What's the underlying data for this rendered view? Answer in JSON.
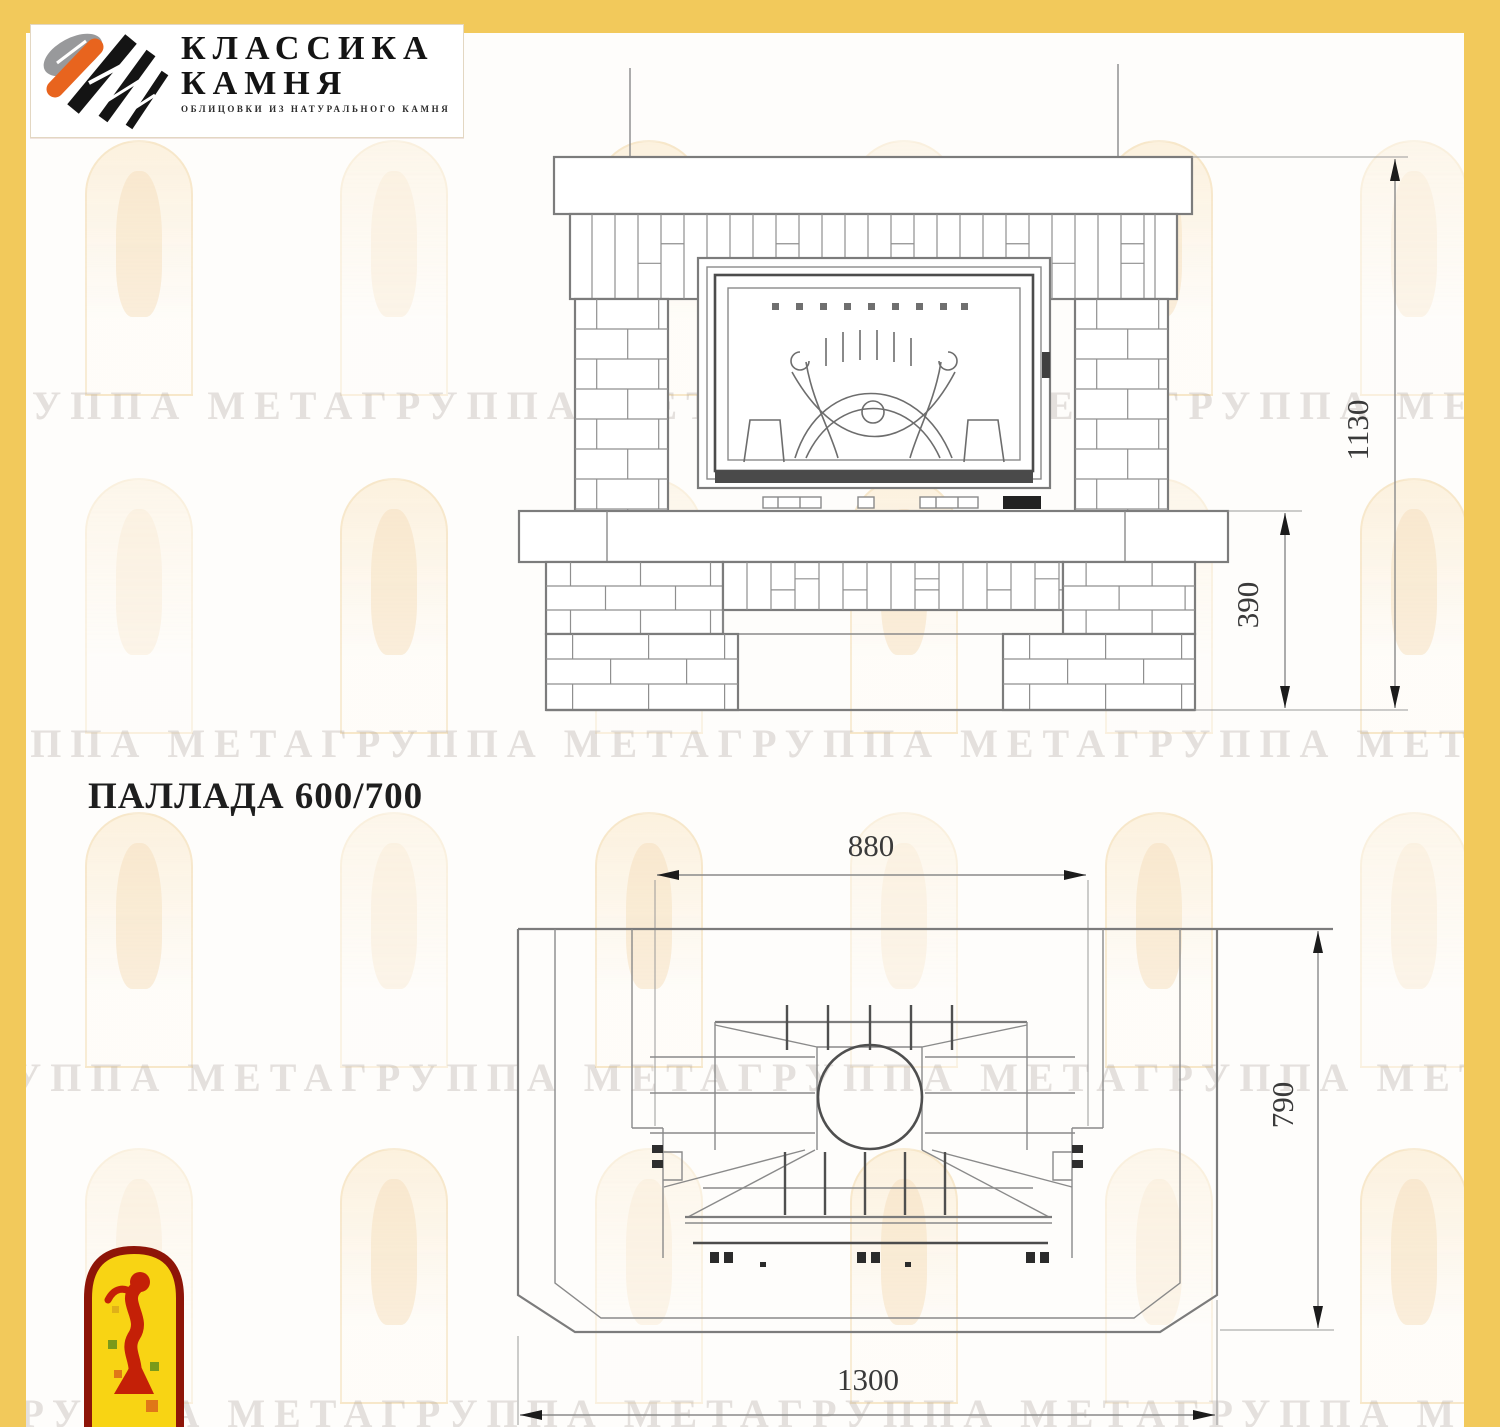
{
  "brand": {
    "name_line1": "КЛАССИКА",
    "name_line2": "КАМНЯ",
    "tagline": "ОБЛИЦОВКИ ИЗ НАТУРАЛЬНОГО КАМНЯ"
  },
  "title": {
    "model": "ПАЛЛАДА 600/700"
  },
  "watermark": {
    "text": "ГРУППА МЕТАГРУППА МЕТАГРУППА МЕТАГРУППА МЕТА"
  },
  "drawing": {
    "front_view": {
      "height_label": "1130",
      "hearth_label": "390"
    },
    "plan_view": {
      "firebox_width_label": "880",
      "depth_label": "790",
      "total_width_label": "1300"
    }
  },
  "colors": {
    "accent_yellow": "#f2c95b",
    "drawing_gray": "#8a8a8a",
    "brand_orange": "#e8641e",
    "arch_logo_red": "#8e1508",
    "arch_logo_yellow": "#f8d414",
    "figure_red": "#c42007"
  }
}
